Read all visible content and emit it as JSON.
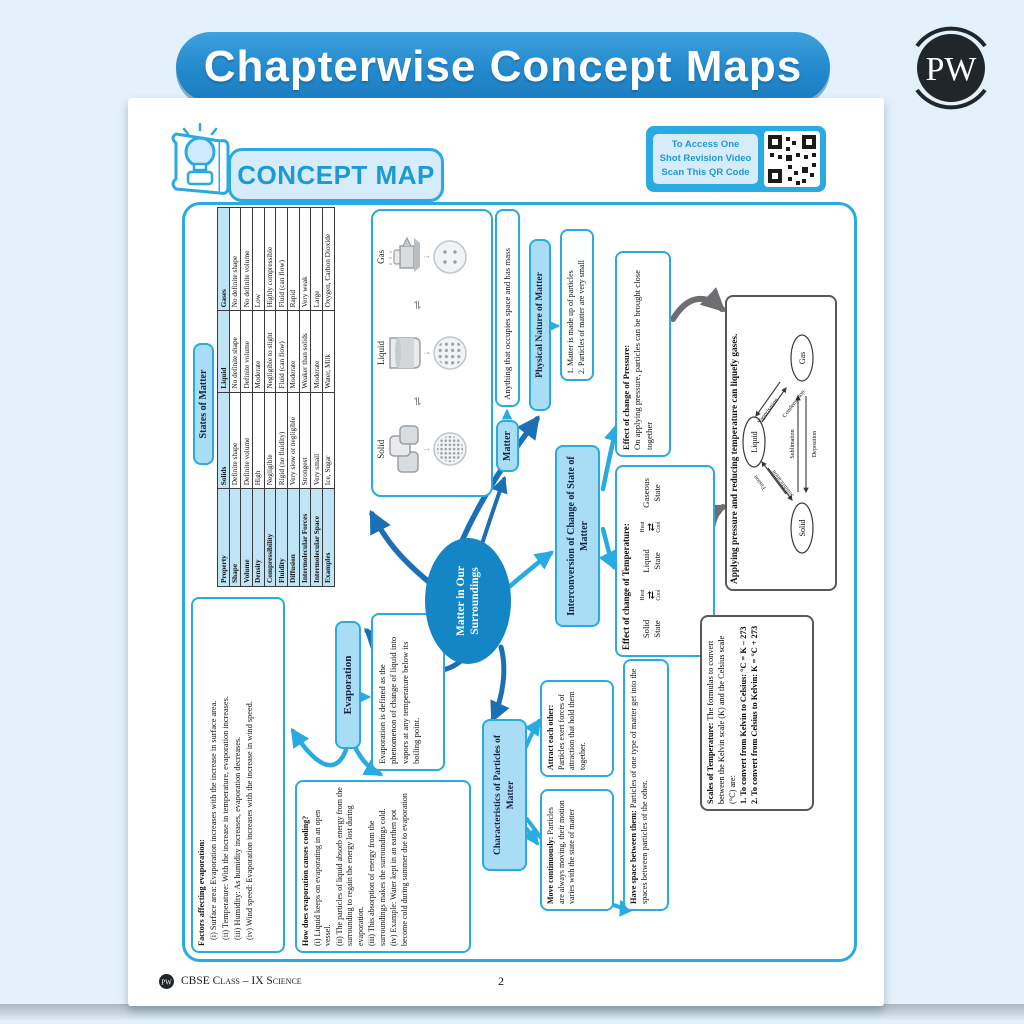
{
  "page": {
    "title": "Chapterwise Concept Maps",
    "logo_letters": "PW",
    "footer_text": "CBSE Class – IX Science",
    "page_number": "2"
  },
  "badge": {
    "label": "CONCEPT MAP"
  },
  "qr": {
    "line1": "To Access One",
    "line2": "Shot Revision Video",
    "line3": "Scan This QR Code"
  },
  "icons": {
    "interchange": "⇌",
    "down_arrow": "↓",
    "exchange": "⇄"
  },
  "colors": {
    "accent": "#29abe2",
    "dark_arrow": "#1c6fb5",
    "gray": "#6d6e71",
    "ellipse": "#1486c5"
  },
  "central": {
    "label": "Matter in Our Surroundings"
  },
  "matter": {
    "label": "Matter",
    "definition": "Anything that occupies space and has mass"
  },
  "physical": {
    "title": "Physical Nature of Matter",
    "point1": "1. Matter is made up of particles",
    "point2": "2. Particles of matter are very small"
  },
  "pressure": {
    "lead": "Effect of change of Pressure:",
    "body": "On applying pressure, particles can be brought close together"
  },
  "interconversion": {
    "title": "Interconversion of Change of State of Matter"
  },
  "temperature": {
    "title": "Effect of change of Temperature:",
    "state1": "Solid State",
    "state2": "Liquid State",
    "state3": "Gaseous State",
    "heat": "Heat",
    "cool": "Cool"
  },
  "liquefy": {
    "title": "Applying pressure and reducing temperature can liquefy gases.",
    "node_liquid": "Liquid",
    "node_solid": "Solid",
    "node_gas": "Gas",
    "vaporisation": "Vaporisation",
    "condensation": "Condensation",
    "fusion": "Fusion",
    "solidification": "Solidification",
    "sublimation": "Sublimation",
    "deposition": "Deposition"
  },
  "scales": {
    "lead": "Scales of Temperature:",
    "body": "The formulas to convert between the Kelvin scale (K) and the Celsius scale (°C) are:",
    "f1": "1. To convert from Kelvin to Celsius: °C = K – 273",
    "f2": "2. To convert from Celsius to Kelvin: K = °C + 273"
  },
  "evaporation": {
    "title": "Evaporation",
    "definition": "Evaporation is defined as the phenomenon of change of liquid into vapors at any temperature below its boiling point."
  },
  "factors": {
    "title": "Factors affecting evaporation:",
    "items": [
      "(i) Surface area: Evaporation increases with the increase in surface area.",
      "(ii) Temperature: With the increase in temperature, evaporation increases.",
      "(iii) Humidity: As humidity increases, evaporation decreases.",
      "(iv) Wind speed: Evaporation increases with the increase in wind speed."
    ]
  },
  "cooling": {
    "title": "How does evaporation causes cooling?",
    "items": [
      "(i) Liquid keeps on evaporating in an open vessel.",
      "(ii) The particles of liquid absorb energy from the surrounding to regain the energy lost during evaporation.",
      "(iii) This absorption of energy from the surroundings makes the surroundings cold.",
      "(iv) Example: Water kept in an earthen pot become cold during summer due to evaporation"
    ]
  },
  "characteristics": {
    "title": "Characteristics of Particles of Matter",
    "move_lead": "Move continuously:",
    "move_body": "Particles are always moving, their motion varies with the state of matter",
    "attract_lead": "Attract each other:",
    "attract_body": "Particles exert forces of attraction that hold them together.",
    "space_lead": "Have space between them:",
    "space_body": "Particles of one type of matter get into the spaces between particles of the other."
  },
  "states_table": {
    "title": "States of Matter",
    "headers": [
      "Property",
      "Solids",
      "Liquid",
      "Gases"
    ],
    "rows": [
      [
        "Shape",
        "Definite shape",
        "No definite shape",
        "No definite shape"
      ],
      [
        "Volume",
        "Definite volume",
        "Definite volume",
        "No definite volume"
      ],
      [
        "Density",
        "High",
        "Moderate",
        "Low"
      ],
      [
        "Compressibility",
        "Negligible",
        "Negligible to slight",
        "Highly compressible"
      ],
      [
        "Fluidity",
        "Rigid (no fluidity)",
        "Fluid (can flow)",
        "Fluid (can flow)"
      ],
      [
        "Diffusion",
        "Very slow or negligible",
        "Moderate",
        "Rapid"
      ],
      [
        "Intermolecular Forces",
        "Strongest",
        "Weaker than solids",
        "Very weak"
      ],
      [
        "Intermolecular Space",
        "Very small",
        "Moderate",
        "Large"
      ],
      [
        "Examples",
        "Ice, Sugar",
        "Water, Milk",
        "Oxygen, Carbon Dioxide"
      ]
    ]
  },
  "illustration": {
    "labels": [
      "Solid",
      "Liquid",
      "Gas"
    ]
  }
}
